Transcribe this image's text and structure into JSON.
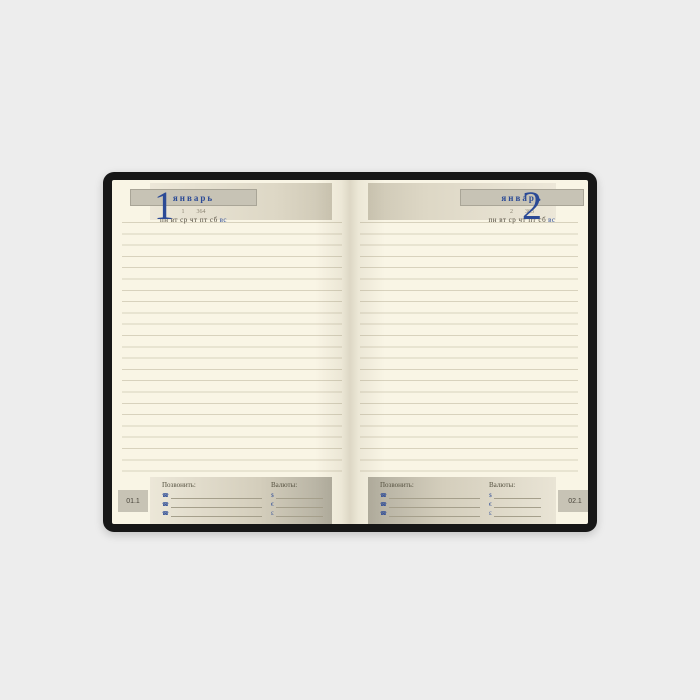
{
  "colors": {
    "background": "#ededed",
    "cover": "#171717",
    "page": "#f9f5e5",
    "accent_blue": "#2b4a96",
    "bar_gray": "#c7c3b5",
    "ruled_line": "#d8d2bd"
  },
  "month": "январь",
  "weekdays": "пн вт ср чт пт сб",
  "sunday": "вс",
  "left_page": {
    "day": "1",
    "day_of_year": "1",
    "days_left": "364",
    "tab": "01.1"
  },
  "right_page": {
    "day": "2",
    "day_of_year": "2",
    "days_left": "363",
    "tab": "02.1"
  },
  "footer": {
    "call_label": "Позвонить:",
    "currencies_label": "Валюты:",
    "phone_icon": "☎",
    "currency_symbols": [
      "$",
      "€",
      "£"
    ]
  }
}
